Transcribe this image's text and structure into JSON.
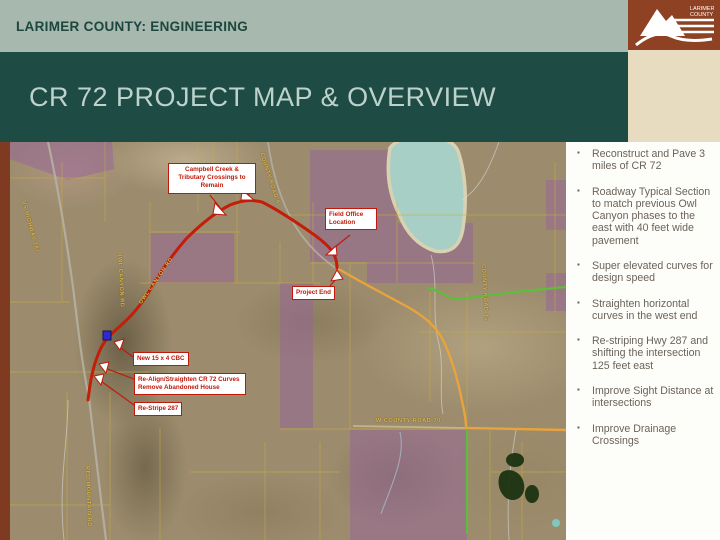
{
  "slide": {
    "eyebrow": "LARIMER COUNTY: ENGINEERING",
    "title": "CR 72 PROJECT MAP & OVERVIEW"
  },
  "logo": {
    "org_line1": "LARIMER",
    "org_line2": "COUNTY"
  },
  "panel": {
    "bullets": [
      "Reconstruct and Pave 3 miles of CR 72",
      "Roadway Typical Section to match previous Owl Canyon phases to the east with 40 feet wide pavement",
      "Super elevated curves for design speed",
      "Straighten horizontal curves in the west end",
      "Re-striping Hwy 287 and shifting the intersection 125 feet east",
      "Improve Sight Distance at intersections",
      "Improve Drainage Crossings"
    ]
  },
  "map": {
    "annotations": [
      {
        "text": "Campbell Creek & Tributary Crossings to Remain"
      },
      {
        "text": "Field Office Location"
      },
      {
        "text": "Project End"
      },
      {
        "text": "New 15 x 4 CBC"
      },
      {
        "text": "Re-Align/Straighten CR 72 Curves Remove Abandoned House"
      },
      {
        "text": "Re-Stripe 287"
      }
    ],
    "road_labels": [
      "US HIGHWAY 287",
      "OWL CANYON RD",
      "OWL CANYON RD",
      "W COUNTY ROAD 70",
      "COUNTY ROAD 15",
      "COUNTY ROAD 9",
      "RED MOUNTAIN RD"
    ],
    "colors": {
      "project_route": "#c41d08",
      "county_road_70_route": "#e8a33d",
      "secondary_route": "#5dbe3b",
      "parcel_overlay": "#96649b",
      "lake": "#a7cfc6"
    }
  },
  "colors": {
    "header_bg": "#a7b8ae",
    "title_bg": "#1e4c44",
    "header_text": "#1d463e",
    "title_text": "#bdd2ca",
    "accent_brown": "#8f4123",
    "left_strip_brown": "#7e3b22",
    "cream": "#e7dcc0",
    "panel_text": "#6b6358",
    "callout_red": "#c0190b"
  }
}
